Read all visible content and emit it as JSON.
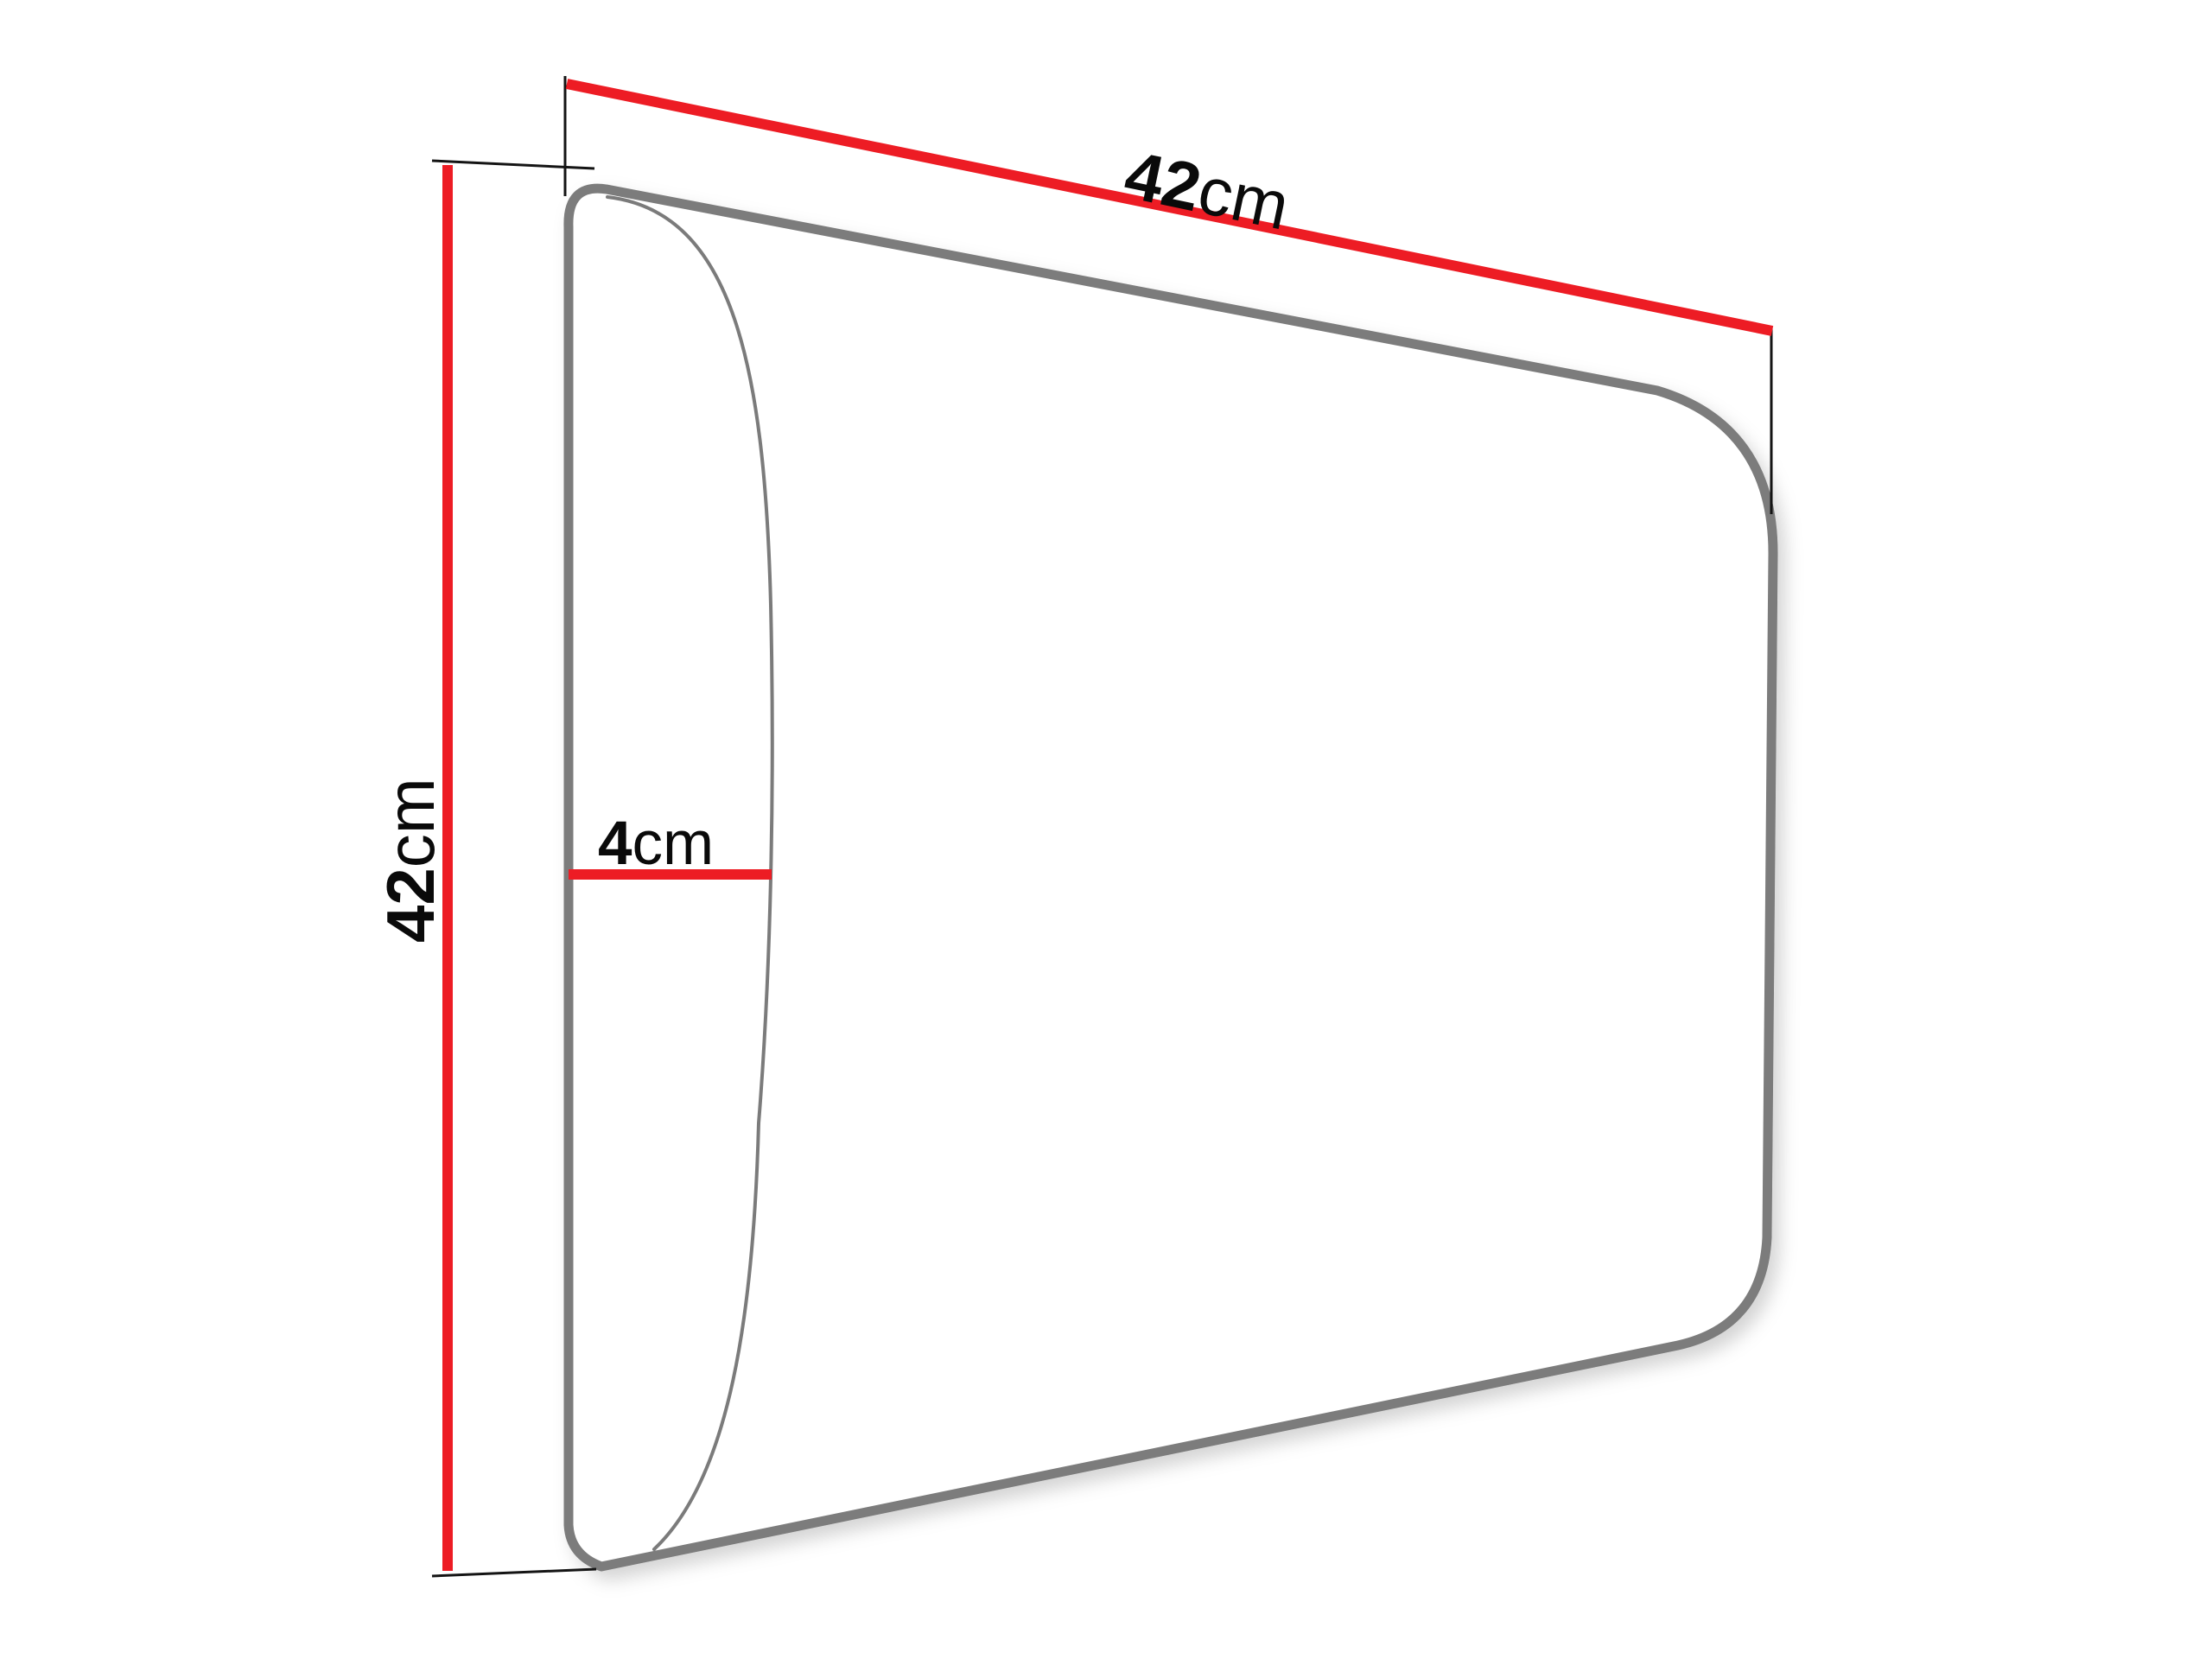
{
  "diagram": {
    "labels": {
      "width": {
        "value": "42",
        "unit": "cm"
      },
      "height": {
        "value": "42",
        "unit": "cm"
      },
      "depth": {
        "value": "4",
        "unit": "cm"
      }
    },
    "colors": {
      "dimension_line": "#ed1c24",
      "panel_outline": "#7b7b7b",
      "extension_line": "#141414",
      "label_text": "#0a0a0a",
      "background": "#ffffff"
    }
  }
}
